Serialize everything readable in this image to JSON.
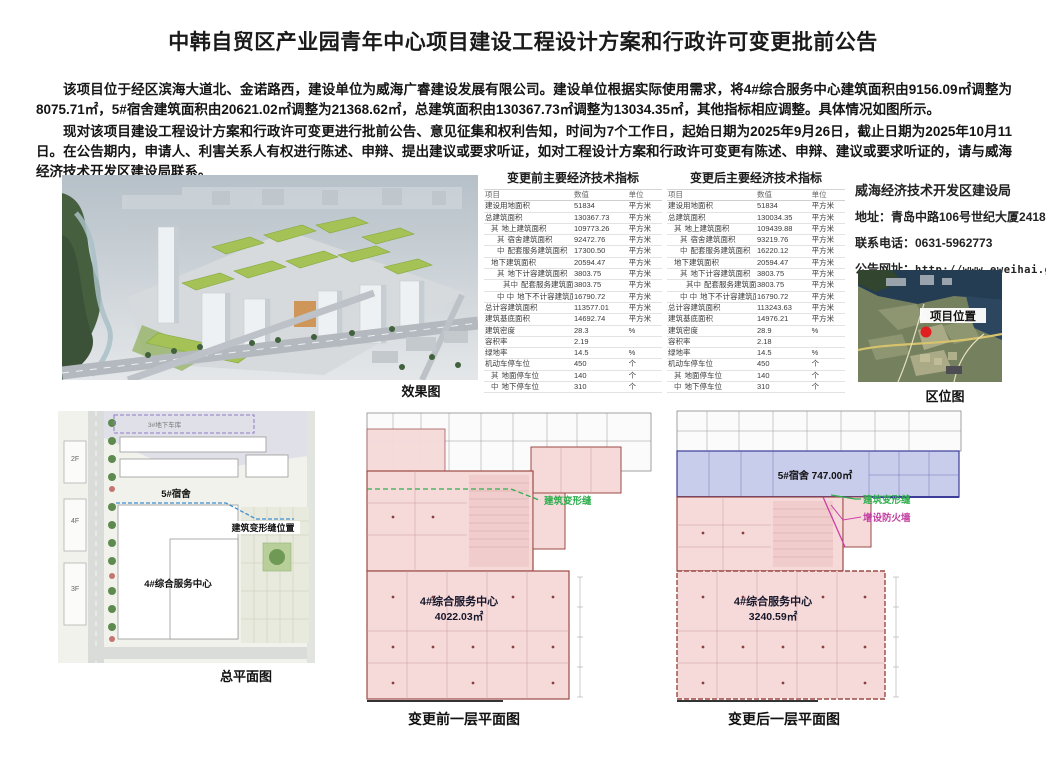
{
  "page": {
    "title": "中韩自贸区产业园青年中心项目建设工程设计方案和行政许可变更批前公告",
    "paragraph1": "该项目位于经区滨海大道北、金诺路西，建设单位为威海广睿建设发展有限公司。建设单位根据实际使用需求，将4#综合服务中心建筑面积由9156.09㎡调整为8075.71㎡，5#宿舍建筑面积由20621.02㎡调整为21368.62㎡，总建筑面积由130367.73㎡调整为13034.35㎡，其他指标相应调整。具体情况如图所示。",
    "paragraph2": "现对该项目建设工程设计方案和行政许可变更进行批前公告、意见征集和权利告知，时间为7个工作日，起始日期为2025年9月26日，截止日期为2025年10月11日。在公告期内，申请人、利害关系人有权进行陈述、申辩、提出建议或要求听证，如对工程设计方案和行政许可变更有陈述、申辩、建议或要求听证的，请与威海经济技术开发区建设局联系。"
  },
  "tables": {
    "before": {
      "title": "变更前主要经济技术指标",
      "headers": [
        "项目",
        "数值",
        "单位"
      ],
      "rows": [
        [
          "",
          "建设用地面积",
          "51834",
          "平方米",
          0
        ],
        [
          "",
          "总建筑面积",
          "130367.73",
          "平方米",
          0
        ],
        [
          "其",
          "地上建筑面积",
          "109773.26",
          "平方米",
          1
        ],
        [
          "其",
          "宿舍建筑面积",
          "92472.76",
          "平方米",
          2
        ],
        [
          "中",
          "配套服务建筑面积",
          "17300.50",
          "平方米",
          2
        ],
        [
          "",
          "地下建筑面积",
          "20594.47",
          "平方米",
          1
        ],
        [
          "其",
          "地下计容建筑面积",
          "3803.75",
          "平方米",
          2
        ],
        [
          "其中",
          "配套服务建筑面积",
          "3803.75",
          "平方米",
          3
        ],
        [
          "中 中",
          "地下不计容建筑面积",
          "16790.72",
          "平方米",
          2
        ],
        [
          "",
          "总计容建筑面积",
          "113577.01",
          "平方米",
          0
        ],
        [
          "",
          "建筑基底面积",
          "14692.74",
          "平方米",
          0
        ],
        [
          "",
          "建筑密度",
          "28.3",
          "%",
          0
        ],
        [
          "",
          "容积率",
          "2.19",
          "",
          0
        ],
        [
          "",
          "绿地率",
          "14.5",
          "%",
          0
        ],
        [
          "",
          "机动车停车位",
          "450",
          "个",
          0
        ],
        [
          "其",
          "地面停车位",
          "140",
          "个",
          1
        ],
        [
          "中",
          "地下停车位",
          "310",
          "个",
          1
        ]
      ]
    },
    "after": {
      "title": "变更后主要经济技术指标",
      "headers": [
        "项目",
        "数值",
        "单位"
      ],
      "rows": [
        [
          "",
          "建设用地面积",
          "51834",
          "平方米",
          0
        ],
        [
          "",
          "总建筑面积",
          "130034.35",
          "平方米",
          0
        ],
        [
          "其",
          "地上建筑面积",
          "109439.88",
          "平方米",
          1
        ],
        [
          "其",
          "宿舍建筑面积",
          "93219.76",
          "平方米",
          2
        ],
        [
          "中",
          "配套服务建筑面积",
          "16220.12",
          "平方米",
          2
        ],
        [
          "",
          "地下建筑面积",
          "20594.47",
          "平方米",
          1
        ],
        [
          "其",
          "地下计容建筑面积",
          "3803.75",
          "平方米",
          2
        ],
        [
          "其中",
          "配套服务建筑面积",
          "3803.75",
          "平方米",
          3
        ],
        [
          "中 中",
          "地下不计容建筑面积",
          "16790.72",
          "平方米",
          2
        ],
        [
          "",
          "总计容建筑面积",
          "113243.63",
          "平方米",
          0
        ],
        [
          "",
          "建筑基底面积",
          "14976.21",
          "平方米",
          0
        ],
        [
          "",
          "建筑密度",
          "28.9",
          "%",
          0
        ],
        [
          "",
          "容积率",
          "2.18",
          "",
          0
        ],
        [
          "",
          "绿地率",
          "14.5",
          "%",
          0
        ],
        [
          "",
          "机动车停车位",
          "450",
          "个",
          0
        ],
        [
          "其",
          "地面停车位",
          "140",
          "个",
          1
        ],
        [
          "中",
          "地下停车位",
          "310",
          "个",
          1
        ]
      ]
    }
  },
  "contact": {
    "department": "威海经济技术开发区建设局",
    "address": "地址：青岛中路106号世纪大厦2418室",
    "phone": "联系电话：0631-5962773",
    "website_label": "公告网址：",
    "website_url": "http://www.eweihai.gov.cn/"
  },
  "figures": {
    "render_caption": "效果图",
    "location_caption": "区位图",
    "location_marker_label": "项目位置",
    "siteplan_caption": "总平面图",
    "siteplan": {
      "garage_label": "3#地下车库",
      "dorm_label": "5#宿舍",
      "joint_label": "建筑变形缝位置",
      "center_label": "4#综合服务中心",
      "floor_2f": "2F",
      "floor_4f": "4F",
      "floor_3f": "3F"
    },
    "plan_before": {
      "caption": "变更前一层平面图",
      "joint_label": "建筑变形缝",
      "area_label": "4#综合服务中心",
      "area_value": "4022.03㎡"
    },
    "plan_after": {
      "caption": "变更后一层平面图",
      "dorm_label": "5#宿舍 747.00㎡",
      "joint_label": "建筑变形缝",
      "firewall_label": "增设防火墙",
      "area_label": "4#综合服务中心",
      "area_value": "3240.59㎡"
    }
  },
  "colors": {
    "joint_green": "#2fae4e",
    "firewall_magenta": "#c23fa0",
    "dorm_band_blue": "#c9cdec",
    "service_pink": "#f6dada",
    "plan_border_red": "#9b4a44",
    "marker_red": "#e02020"
  }
}
